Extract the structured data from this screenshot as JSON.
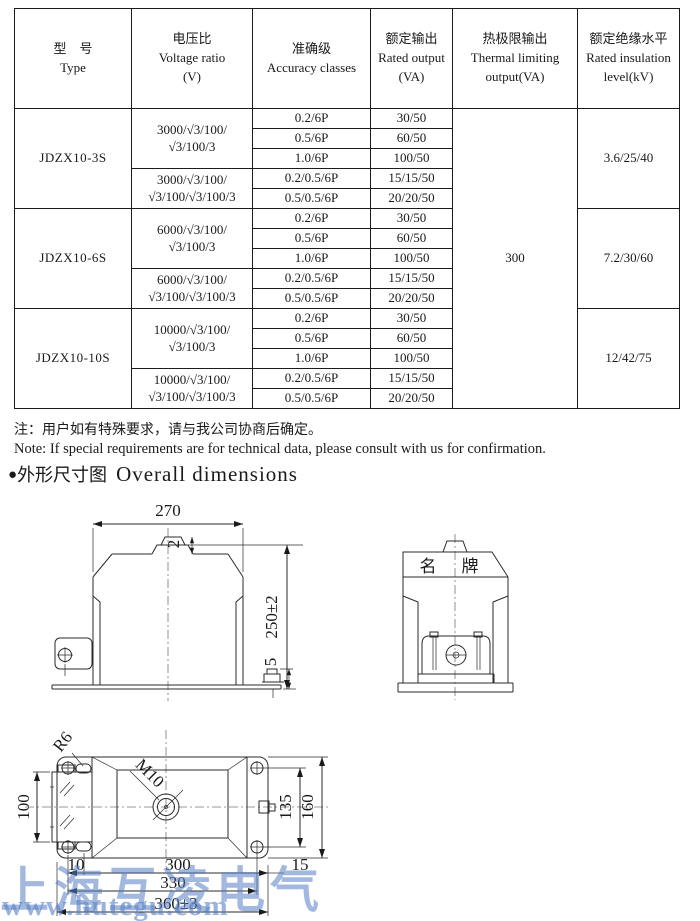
{
  "table": {
    "header": {
      "type": {
        "cn": "型　号",
        "en": "Type"
      },
      "voltage": {
        "cn": "电压比",
        "en": "Voltage ratio",
        "unit": "(V)"
      },
      "accuracy": {
        "cn": "准确级",
        "en": "Accuracy classes"
      },
      "rated": {
        "cn": "额定输出",
        "en": "Rated output",
        "unit": "(VA)"
      },
      "thermal": {
        "cn": "热极限输出",
        "en": "Thermal limiting",
        "en2": "output(VA)"
      },
      "insulation": {
        "cn": "额定绝缘水平",
        "en": "Rated insulation",
        "en2": "level(kV)"
      }
    },
    "thermal_value": "300",
    "groups": [
      {
        "type": "JDZX10-3S",
        "insulation": "3.6/25/40",
        "subgroups": [
          {
            "voltage1": "3000/√3/100/",
            "voltage2": "√3/100/3",
            "rows": [
              {
                "acc": "0.2/6P",
                "out": "30/50"
              },
              {
                "acc": "0.5/6P",
                "out": "60/50"
              },
              {
                "acc": "1.0/6P",
                "out": "100/50"
              }
            ]
          },
          {
            "voltage1": "3000/√3/100/",
            "voltage2": "√3/100/√3/100/3",
            "rows": [
              {
                "acc": "0.2/0.5/6P",
                "out": "15/15/50"
              },
              {
                "acc": "0.5/0.5/6P",
                "out": "20/20/50"
              }
            ]
          }
        ]
      },
      {
        "type": "JDZX10-6S",
        "insulation": "7.2/30/60",
        "subgroups": [
          {
            "voltage1": "6000/√3/100/",
            "voltage2": "√3/100/3",
            "rows": [
              {
                "acc": "0.2/6P",
                "out": "30/50"
              },
              {
                "acc": "0.5/6P",
                "out": "60/50"
              },
              {
                "acc": "1.0/6P",
                "out": "100/50"
              }
            ]
          },
          {
            "voltage1": "6000/√3/100/",
            "voltage2": "√3/100/√3/100/3",
            "rows": [
              {
                "acc": "0.2/0.5/6P",
                "out": "15/15/50"
              },
              {
                "acc": "0.5/0.5/6P",
                "out": "20/20/50"
              }
            ]
          }
        ]
      },
      {
        "type": "JDZX10-10S",
        "insulation": "12/42/75",
        "subgroups": [
          {
            "voltage1": "10000/√3/100/",
            "voltage2": "√3/100/3",
            "rows": [
              {
                "acc": "0.2/6P",
                "out": "30/50"
              },
              {
                "acc": "0.5/6P",
                "out": "60/50"
              },
              {
                "acc": "1.0/6P",
                "out": "100/50"
              }
            ]
          },
          {
            "voltage1": "10000/√3/100/",
            "voltage2": "√3/100/√3/100/3",
            "rows": [
              {
                "acc": "0.2/0.5/6P",
                "out": "15/15/50"
              },
              {
                "acc": "0.5/0.5/6P",
                "out": "20/20/50"
              }
            ]
          }
        ]
      }
    ]
  },
  "notes": {
    "cn": "注：用户如有特殊要求，请与我公司协商后确定。",
    "en": "Note: If special requirements are for technical data, please consult with us for confirmation."
  },
  "section": {
    "bullet": "●",
    "title_cn": "外形尺寸图",
    "title_en": "Overall dimensions"
  },
  "drawing": {
    "front": {
      "width": "270",
      "bump_height": "2",
      "total_height": "250±2",
      "bolt_offset": "5"
    },
    "side": {
      "nameplate": "名　牌"
    },
    "bottom": {
      "corner_radius": "R6",
      "thread": "M10",
      "left_box_height": "100",
      "hole_span_v": "135",
      "overall_depth": "160",
      "hole_offset": "10",
      "slot_span": "300",
      "edge_offset": "15",
      "hole_span_h": "330",
      "overall_width": "360±3"
    }
  },
  "watermark": {
    "line1": "上海互凌电气",
    "line2": "www.hutegu.com"
  }
}
